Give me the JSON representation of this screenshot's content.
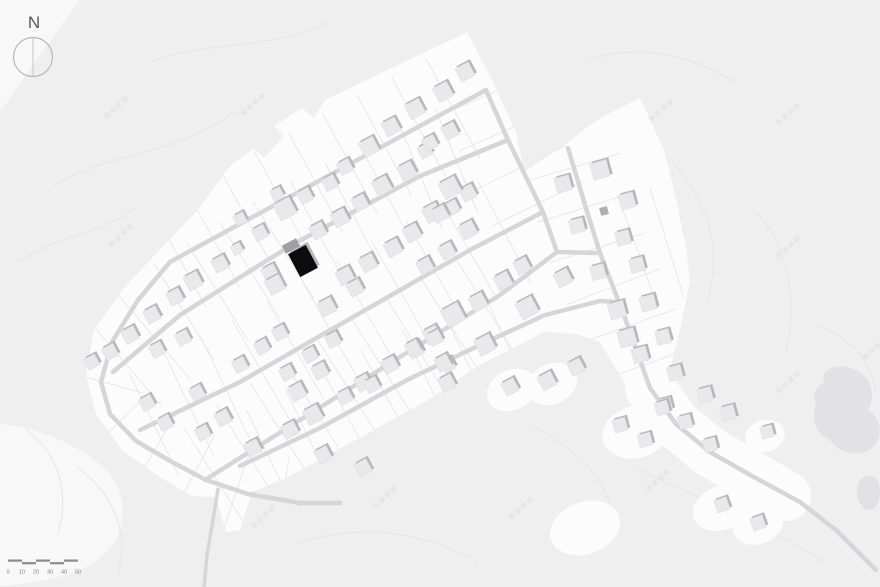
{
  "meta": {
    "width": 880,
    "height": 587,
    "description": "residential site plan with highlighted house"
  },
  "colors": {
    "bg": "#efeff0",
    "white_soft": "#f8f8f9",
    "white": "#fcfcfd",
    "pond": "#e2e2e4",
    "contour": "#e4e4e6",
    "plot": "#e4e4e6",
    "road": "#d6d6d8",
    "house": "#e9e9eb",
    "house_shadow": "#b8b8ba",
    "house_stroke": "#dcdcde",
    "highlight_black": "#0c0c0e",
    "garage_gray": "#a0a0a2",
    "dark_house": "#aeaeb0",
    "scale": "#8c8c8e",
    "north_circle": "#b8b8ba",
    "north_line": "#c6c6c8",
    "watermark": "#e1e1e3"
  },
  "north": {
    "label": "N",
    "cx": 33,
    "cy": 57,
    "r": 19.5
  },
  "scale_bar": {
    "labels": [
      "0",
      "10",
      "20",
      "30",
      "40",
      "50"
    ],
    "x0": 8,
    "seg_w": 14,
    "bar_y": 559.5,
    "bar_h": 2.2,
    "label_y": 573.5
  },
  "watermarks": {
    "text": "知末案例",
    "angle": -42,
    "items": [
      [
        103,
        115
      ],
      [
        240,
        112
      ],
      [
        108,
        243
      ],
      [
        648,
        118
      ],
      [
        775,
        122
      ],
      [
        775,
        255
      ],
      [
        775,
        390
      ],
      [
        372,
        505
      ],
      [
        508,
        516
      ],
      [
        645,
        488
      ],
      [
        862,
        356
      ],
      [
        250,
        525
      ]
    ]
  },
  "terrain": {
    "soft_patches": [
      "M0,0 L80,0 L38,58 L0,112 Z",
      "M0,424 C42,428 84,448 106,470 C126,490 128,522 112,546 C94,570 56,582 0,586 L0,424 Z"
    ],
    "contours": [
      "M55,185 C115,150 170,158 235,112",
      "M18,262 C62,232 95,238 138,206",
      "M150,62 C205,40 265,52 330,22",
      "M588,60 C636,44 688,52 738,84",
      "M672,162 C712,205 722,255 706,305",
      "M756,212 C788,245 798,302 786,352",
      "M818,326 C852,338 870,360 876,392",
      "M636,468 C700,500 762,522 824,562",
      "M532,426 C576,448 600,474 610,504",
      "M296,544 C360,522 425,532 478,562",
      "M78,468 C112,492 130,532 118,572",
      "M26,430 C58,452 70,492 58,534"
    ],
    "white_area": [
      [
        325,
        100
      ],
      [
        467,
        32
      ],
      [
        492,
        80
      ],
      [
        516,
        132
      ],
      [
        524,
        172
      ],
      [
        560,
        148
      ],
      [
        600,
        118
      ],
      [
        640,
        98
      ],
      [
        664,
        150
      ],
      [
        684,
        232
      ],
      [
        690,
        280
      ],
      [
        680,
        330
      ],
      [
        664,
        392
      ],
      [
        640,
        408
      ],
      [
        618,
        372
      ],
      [
        600,
        342
      ],
      [
        576,
        334
      ],
      [
        544,
        332
      ],
      [
        478,
        366
      ],
      [
        428,
        400
      ],
      [
        330,
        454
      ],
      [
        286,
        478
      ],
      [
        252,
        492
      ],
      [
        240,
        530
      ],
      [
        226,
        532
      ],
      [
        216,
        497
      ],
      [
        192,
        496
      ],
      [
        158,
        476
      ],
      [
        122,
        450
      ],
      [
        96,
        414
      ],
      [
        86,
        376
      ],
      [
        94,
        330
      ],
      [
        124,
        288
      ],
      [
        156,
        254
      ],
      [
        198,
        210
      ],
      [
        230,
        166
      ],
      [
        254,
        148
      ],
      [
        264,
        158
      ],
      [
        284,
        136
      ],
      [
        274,
        126
      ],
      [
        302,
        108
      ],
      [
        314,
        118
      ]
    ],
    "white_buffer": [
      [
        650,
        388
      ],
      [
        676,
        424
      ],
      [
        710,
        452
      ],
      [
        752,
        476
      ],
      [
        786,
        496
      ]
    ],
    "white_blobs": [
      [
        585,
        528,
        36,
        26,
        -20
      ],
      [
        636,
        432,
        34,
        26,
        -15
      ],
      [
        722,
        508,
        30,
        22,
        -20
      ],
      [
        758,
        524,
        26,
        20,
        -20
      ],
      [
        765,
        436,
        20,
        16,
        -15
      ],
      [
        512,
        390,
        26,
        20,
        -25
      ],
      [
        552,
        384,
        26,
        20,
        -25
      ]
    ],
    "pond": [
      "M824,382 C820,368 840,362 856,370 C872,378 876,396 868,410 C882,418 884,438 872,448 C858,459 838,452 830,440 C816,434 810,418 816,404 C812,394 816,386 824,382 Z",
      "M862,478 C872,472 880,478 880,492 C880,506 872,514 864,508 C856,502 854,486 862,478 Z"
    ]
  },
  "roads": {
    "default_width": 4.5,
    "lines": [
      {
        "name": "street-1",
        "pts": [
          [
            170,
            262
          ],
          [
            486,
            90
          ]
        ]
      },
      {
        "name": "street-2",
        "pts": [
          [
            113,
            372
          ],
          [
            180,
            315
          ],
          [
            290,
            246
          ],
          [
            420,
            176
          ],
          [
            508,
            140
          ]
        ]
      },
      {
        "name": "street-3",
        "pts": [
          [
            140,
            430
          ],
          [
            240,
            382
          ],
          [
            320,
            336
          ],
          [
            470,
            250
          ],
          [
            543,
            212
          ]
        ]
      },
      {
        "name": "street-4",
        "pts": [
          [
            205,
            480
          ],
          [
            300,
            420
          ],
          [
            400,
            357
          ],
          [
            500,
            295
          ],
          [
            557,
            252
          ]
        ]
      },
      {
        "name": "northeast-edge-road",
        "pts": [
          [
            486,
            90
          ],
          [
            508,
            140
          ],
          [
            543,
            212
          ],
          [
            557,
            252
          ]
        ]
      },
      {
        "name": "junction-connector",
        "pts": [
          [
            557,
            252
          ],
          [
            597,
            253
          ]
        ]
      },
      {
        "name": "east-branch-road",
        "pts": [
          [
            568,
            148
          ],
          [
            585,
            205
          ],
          [
            600,
            253
          ],
          [
            625,
            318
          ],
          [
            650,
            388
          ],
          [
            676,
            424
          ],
          [
            710,
            452
          ],
          [
            752,
            476
          ],
          [
            800,
            502
          ],
          [
            836,
            530
          ],
          [
            876,
            570
          ]
        ]
      },
      {
        "name": "west-south-loop",
        "pts": [
          [
            170,
            262
          ],
          [
            138,
            300
          ],
          [
            112,
            342
          ],
          [
            101,
            382
          ],
          [
            110,
            414
          ],
          [
            136,
            441
          ],
          [
            172,
            462
          ],
          [
            206,
            480
          ],
          [
            248,
            494
          ],
          [
            300,
            503
          ],
          [
            340,
            503
          ]
        ]
      },
      {
        "name": "bottom-street",
        "pts": [
          [
            240,
            466
          ],
          [
            320,
            428
          ],
          [
            407,
            380
          ],
          [
            480,
            345
          ],
          [
            545,
            315
          ],
          [
            600,
            301
          ],
          [
            618,
            302
          ]
        ]
      },
      {
        "name": "south-spur-road",
        "pts": [
          [
            218,
            489
          ],
          [
            213,
            520
          ],
          [
            207,
            555
          ],
          [
            204,
            587
          ]
        ],
        "w": 3.5
      }
    ]
  },
  "plots": {
    "line_width": 0.8,
    "ticks": [
      [
        0,
        39,
        57,
        10,
        350
      ],
      [
        1,
        39,
        57,
        15,
        440
      ],
      [
        2,
        40,
        57,
        15,
        430
      ],
      [
        3,
        40,
        57,
        10,
        360
      ],
      [
        6,
        42,
        50,
        20,
        300
      ],
      [
        8,
        44,
        48,
        30,
        330
      ],
      [
        7,
        46,
        44,
        140,
        420
      ],
      [
        4,
        40,
        50,
        5,
        160
      ],
      [
        6,
        62,
        36,
        320,
        700
      ]
    ],
    "extra_lines": [
      [
        [
          618,
          196
        ],
        [
          658,
          308
        ]
      ],
      [
        [
          650,
          188
        ],
        [
          684,
          298
        ]
      ],
      [
        [
          666,
          150
        ],
        [
          692,
          272
        ]
      ]
    ]
  },
  "houses": {
    "default_rot": -28,
    "items": [
      [
        465,
        72,
        15
      ],
      [
        443,
        92,
        16
      ],
      [
        415,
        109,
        16
      ],
      [
        391,
        127,
        15
      ],
      [
        369,
        147,
        16
      ],
      [
        425,
        151,
        12
      ],
      [
        407,
        171,
        15
      ],
      [
        382,
        186,
        16
      ],
      [
        360,
        203,
        14
      ],
      [
        345,
        167,
        13
      ],
      [
        330,
        183,
        13
      ],
      [
        305,
        196,
        13
      ],
      [
        277,
        194,
        11
      ],
      [
        340,
        218,
        15
      ],
      [
        318,
        231,
        14
      ],
      [
        285,
        209,
        18
      ],
      [
        260,
        233,
        13
      ],
      [
        240,
        219,
        11
      ],
      [
        237,
        249,
        10
      ],
      [
        220,
        264,
        14
      ],
      [
        193,
        281,
        15
      ],
      [
        270,
        273,
        14
      ],
      [
        345,
        276,
        15
      ],
      [
        368,
        263,
        15
      ],
      [
        393,
        248,
        15
      ],
      [
        412,
        233,
        15
      ],
      [
        432,
        213,
        16
      ],
      [
        452,
        208,
        13
      ],
      [
        468,
        193,
        14
      ],
      [
        450,
        131,
        14
      ],
      [
        430,
        143,
        13
      ],
      [
        450,
        188,
        18
      ],
      [
        440,
        214,
        14
      ],
      [
        468,
        230,
        15
      ],
      [
        425,
        266,
        14
      ],
      [
        447,
        251,
        14
      ],
      [
        503,
        281,
        15
      ],
      [
        522,
        266,
        14
      ],
      [
        275,
        285,
        16
      ],
      [
        327,
        307,
        15
      ],
      [
        355,
        288,
        14
      ],
      [
        175,
        297,
        14
      ],
      [
        152,
        315,
        14
      ],
      [
        130,
        335,
        14
      ],
      [
        110,
        352,
        13
      ],
      [
        92,
        362,
        12
      ],
      [
        453,
        315,
        19
      ],
      [
        432,
        335,
        15
      ],
      [
        415,
        350,
        14
      ],
      [
        478,
        302,
        15
      ],
      [
        527,
        308,
        18
      ],
      [
        485,
        345,
        17
      ],
      [
        448,
        365,
        12
      ],
      [
        320,
        371,
        14
      ],
      [
        297,
        392,
        15
      ],
      [
        363,
        383,
        14
      ],
      [
        390,
        365,
        14
      ],
      [
        240,
        365,
        13
      ],
      [
        287,
        373,
        13
      ],
      [
        310,
        355,
        13
      ],
      [
        333,
        340,
        13
      ],
      [
        262,
        347,
        13
      ],
      [
        280,
        333,
        13
      ],
      [
        183,
        338,
        13
      ],
      [
        157,
        350,
        13
      ],
      [
        147,
        403,
        13
      ],
      [
        165,
        423,
        13
      ],
      [
        197,
        393,
        13
      ],
      [
        223,
        418,
        14
      ],
      [
        203,
        433,
        13
      ],
      [
        253,
        448,
        14
      ],
      [
        290,
        430,
        14
      ],
      [
        323,
        455,
        14
      ],
      [
        363,
        468,
        14
      ],
      [
        313,
        415,
        16
      ],
      [
        345,
        397,
        13
      ],
      [
        372,
        385,
        13
      ],
      [
        413,
        348,
        13
      ],
      [
        435,
        338,
        13
      ],
      [
        443,
        363,
        14
      ],
      [
        447,
        383,
        14
      ],
      [
        510,
        387,
        14
      ],
      [
        547,
        381,
        15
      ],
      [
        576,
        367,
        14
      ],
      [
        563,
        278,
        15
      ],
      [
        598,
        272,
        14,
        -15
      ],
      [
        617,
        310,
        16,
        -15
      ],
      [
        627,
        338,
        17,
        -15
      ],
      [
        640,
        355,
        15,
        -15
      ],
      [
        648,
        303,
        15,
        -15
      ],
      [
        663,
        337,
        14,
        -15
      ],
      [
        600,
        170,
        17,
        -15
      ],
      [
        563,
        184,
        15,
        -15
      ],
      [
        627,
        201,
        15,
        -15
      ],
      [
        577,
        226,
        14,
        -15
      ],
      [
        623,
        238,
        14,
        -15
      ],
      [
        637,
        265,
        14,
        -15
      ],
      [
        675,
        373,
        14,
        -15
      ],
      [
        705,
        395,
        14,
        -15
      ],
      [
        665,
        405,
        13,
        -15
      ],
      [
        685,
        422,
        13,
        -15
      ],
      [
        728,
        413,
        14,
        -15
      ],
      [
        710,
        445,
        13,
        -15
      ],
      [
        722,
        505,
        13,
        -20
      ],
      [
        758,
        523,
        13,
        -20
      ],
      [
        620,
        425,
        13,
        -15
      ],
      [
        645,
        440,
        13,
        -15
      ],
      [
        662,
        408,
        13,
        -15
      ],
      [
        767,
        432,
        12,
        -15
      ]
    ]
  },
  "special_buildings": [
    {
      "name": "garage-annex",
      "x": 291,
      "y": 246,
      "w": 16,
      "h": 9,
      "rot": -28,
      "fill_key": "garage_gray",
      "shadow": false
    },
    {
      "name": "highlighted-house",
      "x": 303,
      "y": 261,
      "w": 20,
      "h": 26,
      "rot": -28,
      "fill_key": "highlight_black",
      "shadow": true
    },
    {
      "name": "small-dark-house",
      "x": 604,
      "y": 211,
      "w": 8,
      "h": 8,
      "rot": -15,
      "fill_key": "dark_house",
      "shadow": false
    }
  ]
}
